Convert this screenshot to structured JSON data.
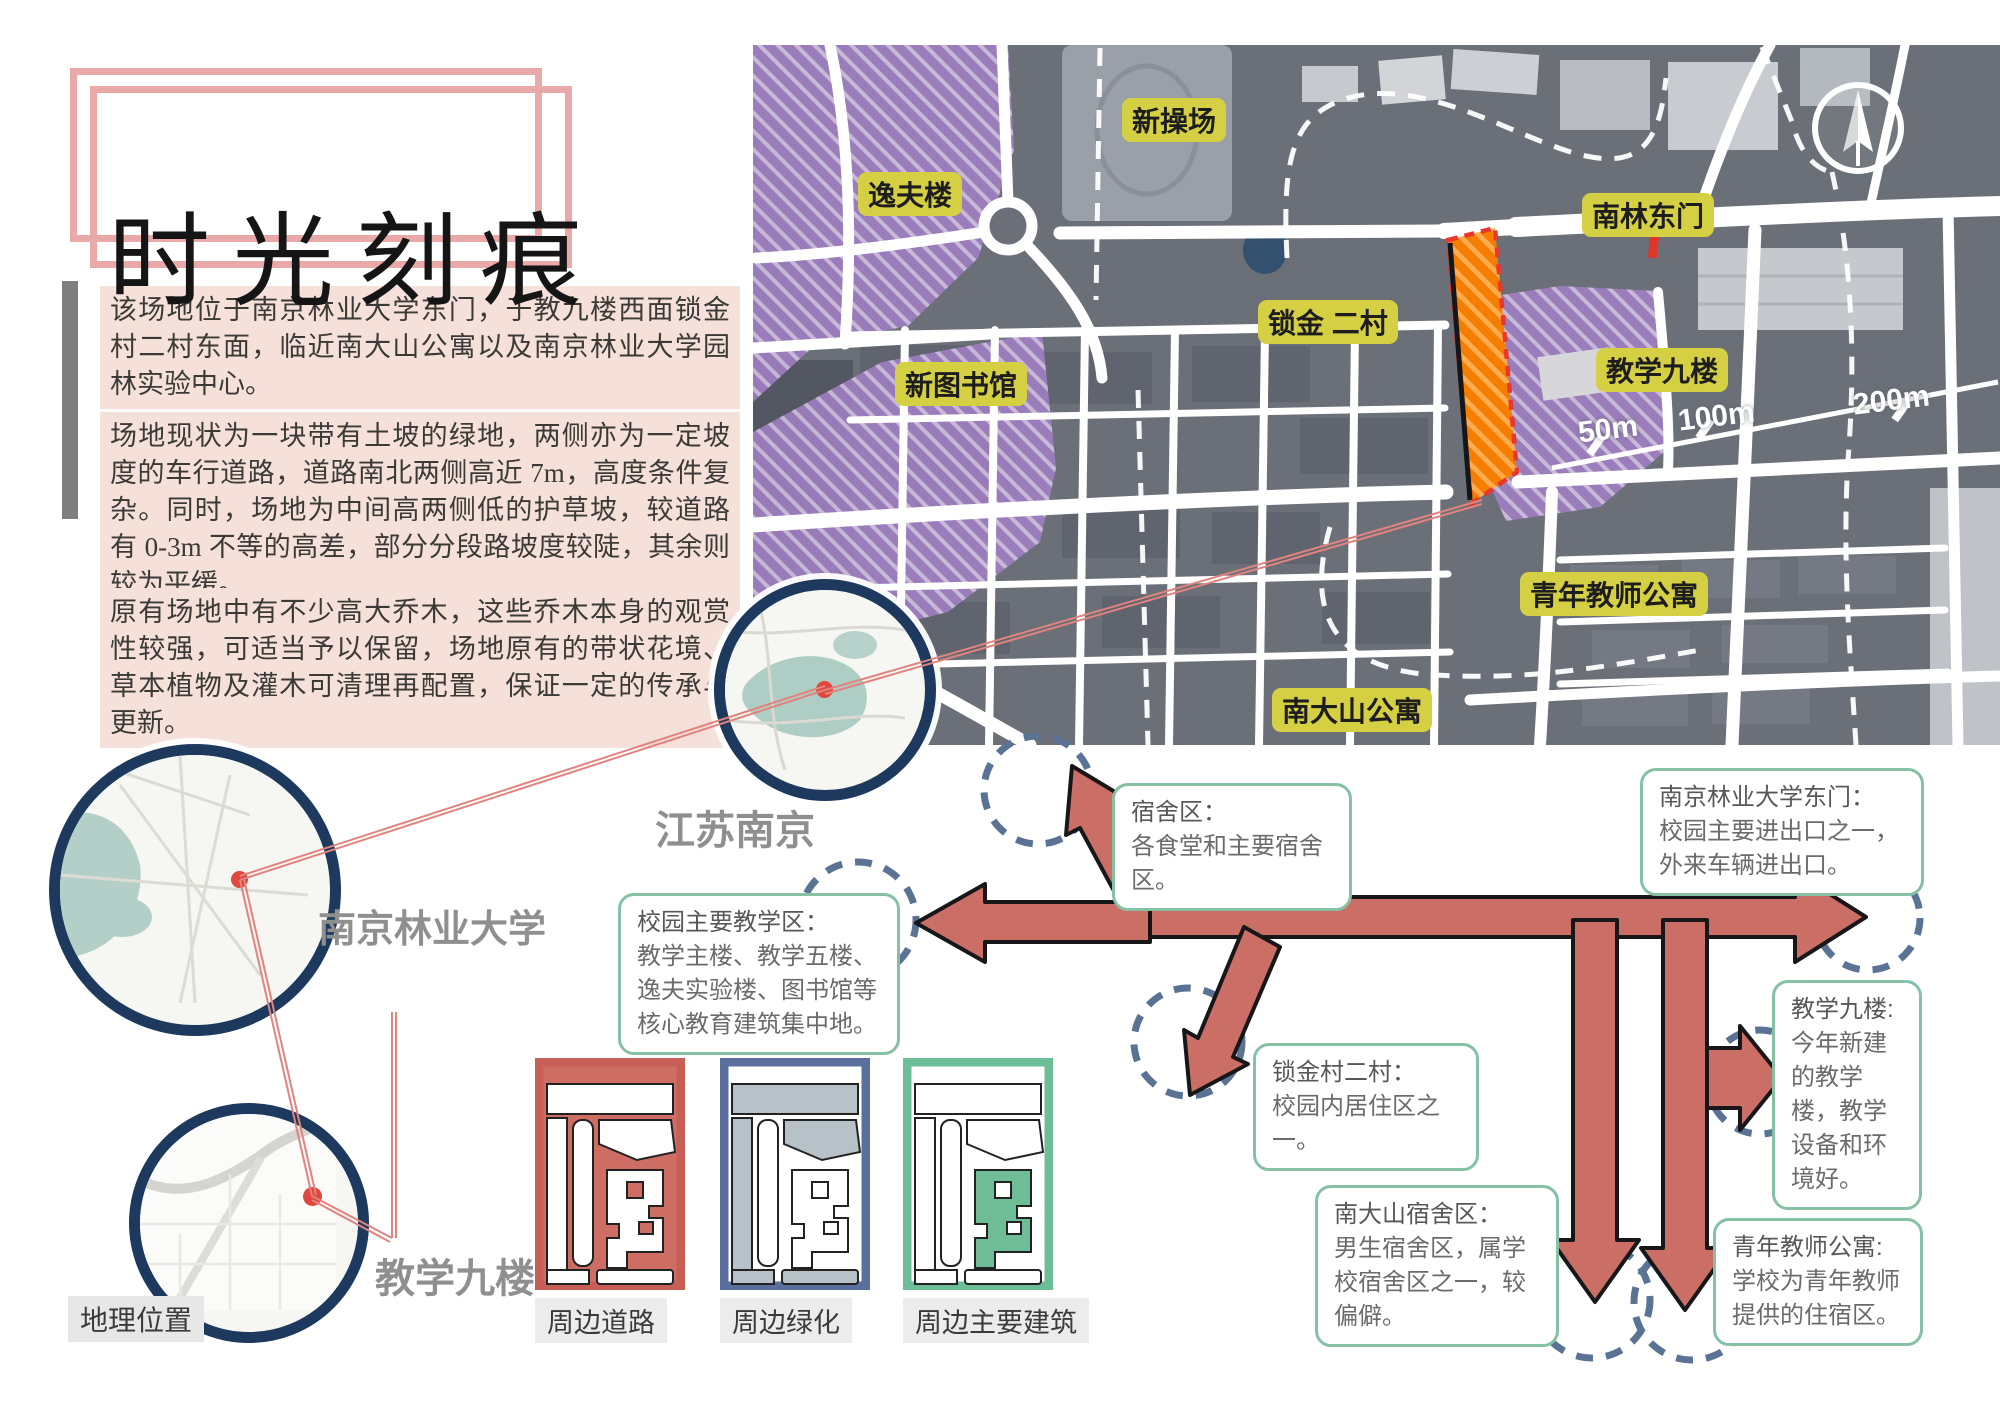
{
  "board": {
    "title": "时光刻痕"
  },
  "intro": {
    "paragraphs": [
      "该场地位于南京林业大学东门，于教九楼西面锁金村二村东面，临近南大山公寓以及南京林业大学园林实验中心。",
      "场地现状为一块带有土坡的绿地，两侧亦为一定坡度的车行道路，道路南北两侧高近 7m，高度条件复杂。同时，场地为中间高两侧低的护草坡，较道路有 0-3m 不等的高差，部分分段路坡度较陡，其余则较为平缓。",
      "原有场地中有不少高大乔木，这些乔木本身的观赏性较强，可适当予以保留，场地原有的带状花境、草本植物及灌木可清理再配置，保证一定的传承与更新。"
    ]
  },
  "map": {
    "labels": [
      {
        "text": "新操场"
      },
      {
        "text": "逸夫楼"
      },
      {
        "text": "新图书馆"
      },
      {
        "text": "锁金 二村"
      },
      {
        "text": "南林东门"
      },
      {
        "text": "教学九楼"
      },
      {
        "text": "青年教师公寓"
      },
      {
        "text": "南大山公寓"
      }
    ],
    "scale_marks": [
      {
        "text": "50m"
      },
      {
        "text": "100m"
      },
      {
        "text": "200m"
      }
    ]
  },
  "insets": {
    "caption": "地理位置",
    "items": [
      {
        "label": "江苏南京"
      },
      {
        "label": "南京林业大学"
      },
      {
        "label": "教学九楼"
      }
    ]
  },
  "legend": {
    "items": [
      {
        "label": "周边道路",
        "color": "#c75f57"
      },
      {
        "label": "周边绿化",
        "color": "#5b6f9e"
      },
      {
        "label": "周边主要建筑",
        "color": "#6cbe97"
      }
    ]
  },
  "callouts": {
    "items": [
      {
        "title": "宿舍区：",
        "body": "各食堂和主要宿舍区。"
      },
      {
        "title": "南京林业大学东门：",
        "body": "校园主要进出口之一，外来车辆进出口。"
      },
      {
        "title": "校园主要教学区：",
        "body": "教学主楼、教学五楼、逸夫实验楼、图书馆等核心教育建筑集中地。"
      },
      {
        "title": "锁金村二村：",
        "body": "校园内居住区之一。"
      },
      {
        "title": "南大山宿舍区：",
        "body": "男生宿舍区，属学校宿舍区之一，较偏僻。"
      },
      {
        "title": "教学九楼:",
        "body": "今年新建的教学楼，教学设备和环境好。"
      },
      {
        "title": "青年教师公寓:",
        "body": "学校为青年教师提供的住宿区。"
      }
    ]
  },
  "colors": {
    "accent_pink": "#e9a9a8",
    "paragraph_bg": "#f5e0da",
    "map_purple": "#9e7ec0",
    "site_orange": "#f57d00",
    "label_yellow": "#d5cf44",
    "arrow_red": "#cb6f66",
    "circle_navy": "#1d3a5e",
    "dashed_blue": "#5a7395",
    "callout_green": "#86c1a5"
  }
}
